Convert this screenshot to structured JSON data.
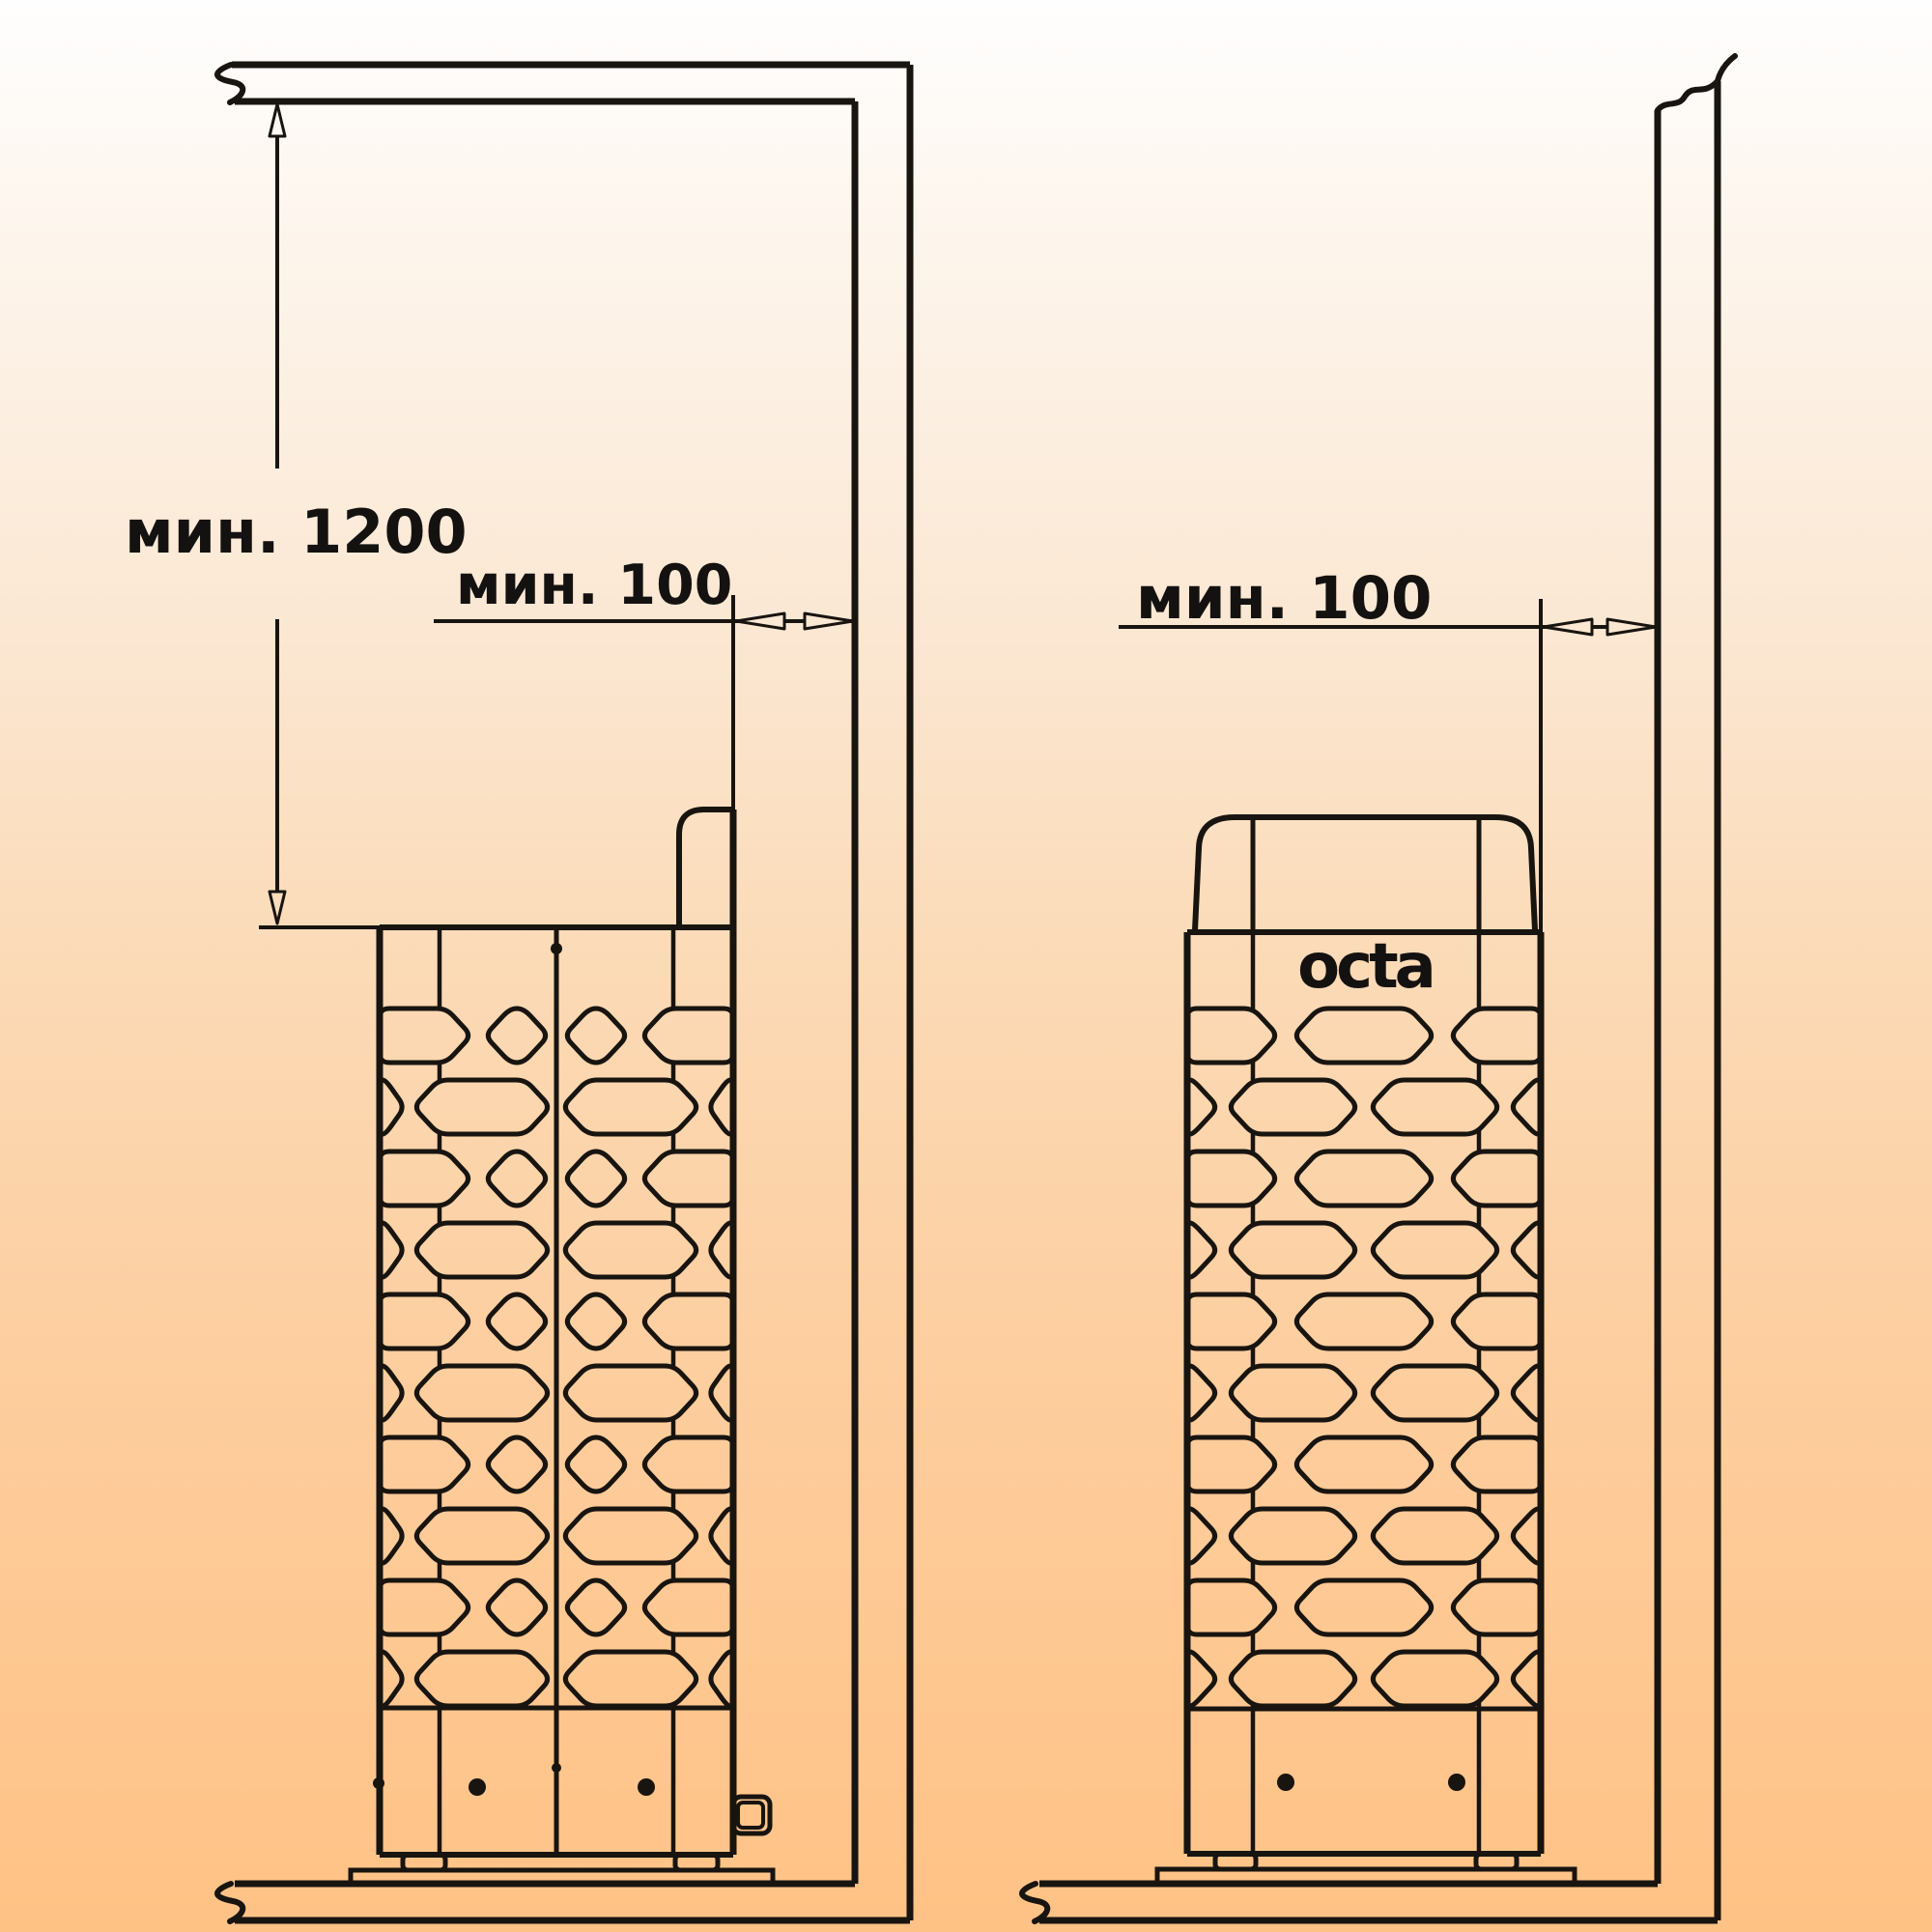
{
  "left_view": {
    "vertical_dimension_label": "мин. 1200",
    "horizontal_dimension_label": "мин. 100"
  },
  "right_view": {
    "horizontal_dimension_label": "мин. 100",
    "heater_logo": "octa"
  },
  "colors": {
    "line": "#181410",
    "background_top": "#fffefe",
    "background_bottom": "#ffc285"
  }
}
